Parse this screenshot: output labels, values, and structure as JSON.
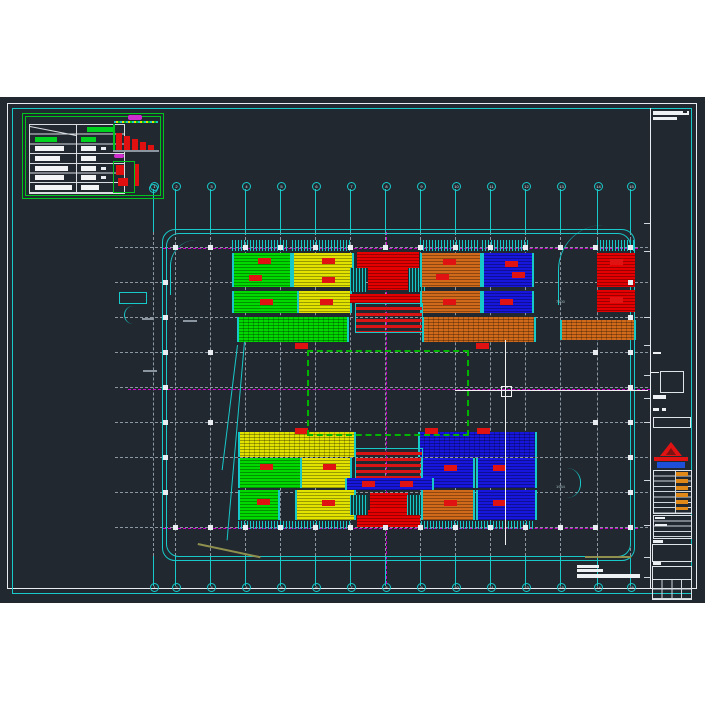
{
  "app": {
    "description": "CAD model-space view of a floor plan drawing with colored zone blocks, grid bubbles, legend table and title block",
    "background_color": "#212830",
    "sheet_frame_colors": {
      "outer": "#e9edf1",
      "inner": "#18c9c9"
    }
  },
  "colors": {
    "green": "#00d800",
    "yellow": "#e2e200",
    "red": "#e40000",
    "orange": "#d06a1a",
    "blue": "#1616dc",
    "magenta": "#cf00cf",
    "cyan": "#18c9c9",
    "grid": "#8d97a2",
    "legend_green": "#00c31f",
    "olive": "#8f8f4e"
  },
  "drawing": {
    "grid": {
      "cols": [
        {
          "x": 153,
          "label": "1"
        },
        {
          "x": 175,
          "label": "2"
        },
        {
          "x": 210,
          "label": "3"
        },
        {
          "x": 245,
          "label": "4"
        },
        {
          "x": 280,
          "label": "5"
        },
        {
          "x": 315,
          "label": "6"
        },
        {
          "x": 350,
          "label": "7"
        },
        {
          "x": 385,
          "label": "8"
        },
        {
          "x": 420,
          "label": "9"
        },
        {
          "x": 455,
          "label": "10"
        },
        {
          "x": 490,
          "label": "11"
        },
        {
          "x": 525,
          "label": "12"
        },
        {
          "x": 560,
          "label": "13"
        },
        {
          "x": 597,
          "label": "14"
        },
        {
          "x": 630,
          "label": "15"
        }
      ],
      "rows_y": [
        247,
        282,
        317,
        352,
        387,
        422,
        457,
        492,
        527
      ],
      "row_x1": 115,
      "row_x2": 648,
      "top_bubble_y": 185,
      "bottom_bubble_y": 586,
      "col_dash_y1": 232,
      "col_dash_y2": 556
    },
    "magenta_lines": {
      "horizontal": [
        {
          "y": 248,
          "x1": 163,
          "x2": 638
        },
        {
          "y": 389,
          "x1": 128,
          "x2": 650
        },
        {
          "y": 528,
          "x1": 163,
          "x2": 638
        }
      ],
      "vertical": [
        {
          "x": 386,
          "y1": 232,
          "y2": 584
        }
      ]
    },
    "outline": {
      "x": 162,
      "y": 229,
      "w": 471,
      "h": 330
    },
    "green_dashed_rect": {
      "x": 307,
      "y": 350,
      "w": 158,
      "h": 82
    },
    "blocks": [
      {
        "x": 232,
        "y": 240,
        "w": 56,
        "h": 11,
        "c": "comb"
      },
      {
        "x": 292,
        "y": 240,
        "w": 58,
        "h": 11,
        "c": "comb"
      },
      {
        "x": 420,
        "y": 240,
        "w": 58,
        "h": 11,
        "c": "comb"
      },
      {
        "x": 482,
        "y": 240,
        "w": 48,
        "h": 11,
        "c": "comb"
      },
      {
        "x": 597,
        "y": 240,
        "w": 38,
        "h": 11,
        "c": "comb"
      },
      {
        "x": 232,
        "y": 253,
        "w": 56,
        "h": 34,
        "c": "green"
      },
      {
        "x": 292,
        "y": 253,
        "w": 58,
        "h": 34,
        "c": "yellow"
      },
      {
        "x": 357,
        "y": 252,
        "w": 62,
        "h": 16,
        "c": "red"
      },
      {
        "x": 368,
        "y": 268,
        "w": 40,
        "h": 22,
        "c": "red"
      },
      {
        "x": 350,
        "y": 268,
        "w": 16,
        "h": 24,
        "c": "teal"
      },
      {
        "x": 409,
        "y": 268,
        "w": 16,
        "h": 24,
        "c": "teal"
      },
      {
        "x": 420,
        "y": 253,
        "w": 58,
        "h": 34,
        "c": "orange"
      },
      {
        "x": 482,
        "y": 253,
        "w": 48,
        "h": 34,
        "c": "blue"
      },
      {
        "x": 597,
        "y": 253,
        "w": 38,
        "h": 34,
        "c": "red"
      },
      {
        "x": 232,
        "y": 291,
        "w": 63,
        "h": 22,
        "c": "green"
      },
      {
        "x": 297,
        "y": 291,
        "w": 51,
        "h": 22,
        "c": "yellow"
      },
      {
        "x": 350,
        "y": 294,
        "w": 75,
        "h": 9,
        "c": "red"
      },
      {
        "x": 420,
        "y": 291,
        "w": 58,
        "h": 22,
        "c": "orange"
      },
      {
        "x": 482,
        "y": 291,
        "w": 48,
        "h": 22,
        "c": "blue"
      },
      {
        "x": 597,
        "y": 290,
        "w": 38,
        "h": 22,
        "c": "red"
      },
      {
        "x": 237,
        "y": 317,
        "w": 108,
        "h": 25,
        "c": "green",
        "t": "hatch"
      },
      {
        "x": 422,
        "y": 317,
        "w": 110,
        "h": 25,
        "c": "orange",
        "t": "hatch"
      },
      {
        "x": 560,
        "y": 320,
        "w": 72,
        "h": 20,
        "c": "orange",
        "t": "hatch"
      },
      {
        "x": 355,
        "y": 303,
        "w": 66,
        "h": 28,
        "c": "stage"
      },
      {
        "x": 238,
        "y": 432,
        "w": 114,
        "h": 25,
        "c": "yellow",
        "t": "hatch"
      },
      {
        "x": 418,
        "y": 432,
        "w": 115,
        "h": 25,
        "c": "blue",
        "t": "hatch"
      },
      {
        "x": 355,
        "y": 448,
        "w": 66,
        "h": 30,
        "c": "stage"
      },
      {
        "x": 238,
        "y": 458,
        "w": 60,
        "h": 30,
        "c": "green"
      },
      {
        "x": 300,
        "y": 458,
        "w": 48,
        "h": 30,
        "c": "yellow"
      },
      {
        "x": 421,
        "y": 458,
        "w": 50,
        "h": 30,
        "c": "blue"
      },
      {
        "x": 476,
        "y": 458,
        "w": 57,
        "h": 30,
        "c": "blue"
      },
      {
        "x": 345,
        "y": 478,
        "w": 85,
        "h": 12,
        "c": "blue"
      },
      {
        "x": 238,
        "y": 490,
        "w": 38,
        "h": 30,
        "c": "green"
      },
      {
        "x": 295,
        "y": 490,
        "w": 57,
        "h": 30,
        "c": "yellow"
      },
      {
        "x": 370,
        "y": 493,
        "w": 38,
        "h": 17,
        "c": "red"
      },
      {
        "x": 357,
        "y": 510,
        "w": 63,
        "h": 17,
        "c": "red"
      },
      {
        "x": 350,
        "y": 495,
        "w": 18,
        "h": 20,
        "c": "teal"
      },
      {
        "x": 407,
        "y": 495,
        "w": 18,
        "h": 20,
        "c": "teal"
      },
      {
        "x": 421,
        "y": 490,
        "w": 50,
        "h": 30,
        "c": "orange"
      },
      {
        "x": 476,
        "y": 490,
        "w": 57,
        "h": 30,
        "c": "blue"
      },
      {
        "x": 238,
        "y": 521,
        "w": 114,
        "h": 8,
        "c": "comb"
      },
      {
        "x": 421,
        "y": 521,
        "w": 112,
        "h": 8,
        "c": "comb"
      }
    ],
    "chips": [
      [
        258,
        258
      ],
      [
        249,
        275
      ],
      [
        322,
        258
      ],
      [
        322,
        277
      ],
      [
        443,
        259
      ],
      [
        436,
        274
      ],
      [
        505,
        261
      ],
      [
        512,
        272
      ],
      [
        610,
        259
      ],
      [
        260,
        299
      ],
      [
        320,
        299
      ],
      [
        443,
        299
      ],
      [
        500,
        299
      ],
      [
        610,
        297
      ],
      [
        295,
        343
      ],
      [
        476,
        343
      ],
      [
        295,
        428
      ],
      [
        425,
        428
      ],
      [
        477,
        428
      ],
      [
        260,
        464
      ],
      [
        323,
        464
      ],
      [
        444,
        465
      ],
      [
        493,
        465
      ],
      [
        362,
        481
      ],
      [
        400,
        481
      ],
      [
        257,
        499
      ],
      [
        322,
        500
      ],
      [
        444,
        500
      ],
      [
        493,
        500
      ]
    ],
    "squares": {
      "top_row_y": 247,
      "bottom_row_y": 527,
      "row_cols": [
        175,
        210,
        245,
        280,
        315,
        350,
        385,
        420,
        455,
        490,
        525,
        560,
        595,
        630
      ],
      "left_col_x": 165,
      "right_col_x": 630,
      "col_rows": [
        282,
        317,
        352,
        387,
        422,
        457,
        492
      ],
      "extra": [
        [
          210,
          352
        ],
        [
          595,
          352
        ],
        [
          210,
          422
        ],
        [
          595,
          422
        ]
      ]
    },
    "cursor": {
      "x": 505,
      "y": 390,
      "h_x1": 455,
      "h_x2": 648,
      "v_y1": 340,
      "v_y2": 545
    },
    "annotations": {
      "dim_a": "7500",
      "dim_b": "1954"
    }
  }
}
